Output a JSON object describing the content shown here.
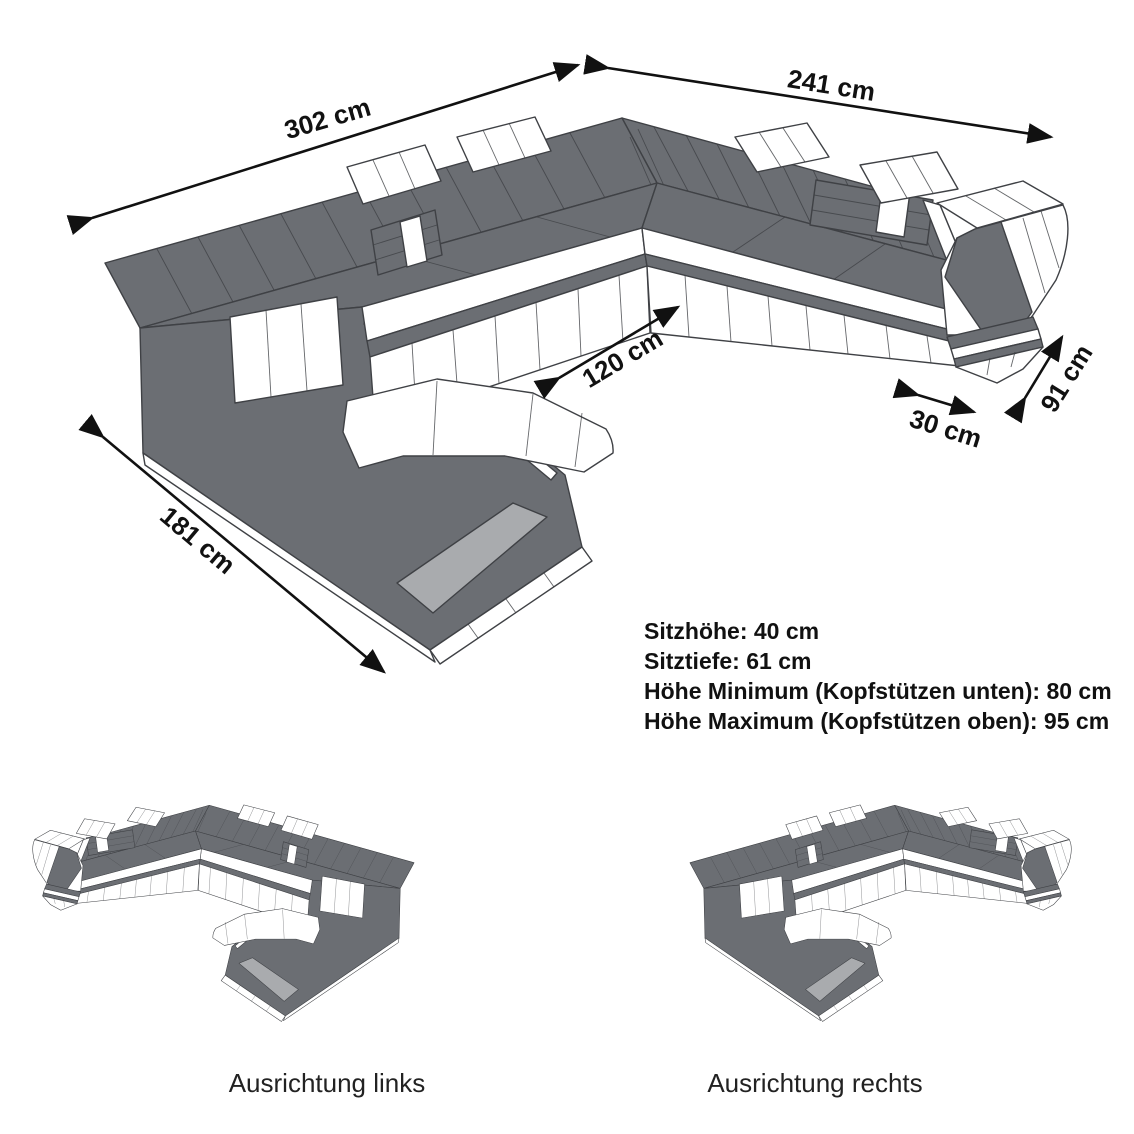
{
  "diagram": {
    "title_hint": "U-shaped sectional sofa dimension diagram",
    "dimension_labels": {
      "back_left": "302 cm",
      "back_right": "241 cm",
      "inner_width": "120 cm",
      "armrest_width": "30 cm",
      "right_depth": "91 cm",
      "left_depth": "181 cm"
    },
    "specs": {
      "line1": "Sitzhöhe: 40 cm",
      "line2": "Sitztiefe: 61 cm",
      "line3": "Höhe Minimum (Kopfstützen unten): 80 cm",
      "line4": "Höhe Maximum (Kopfstützen oben): 95 cm"
    },
    "variants": {
      "left_label": "Ausrichtung links",
      "right_label": "Ausrichtung rechts"
    },
    "colors": {
      "body_gray": "#6B6E73",
      "panel_gray": "#A9ABAE",
      "outline": "#3F4145",
      "white": "#FFFFFF",
      "text": "#111111"
    }
  }
}
